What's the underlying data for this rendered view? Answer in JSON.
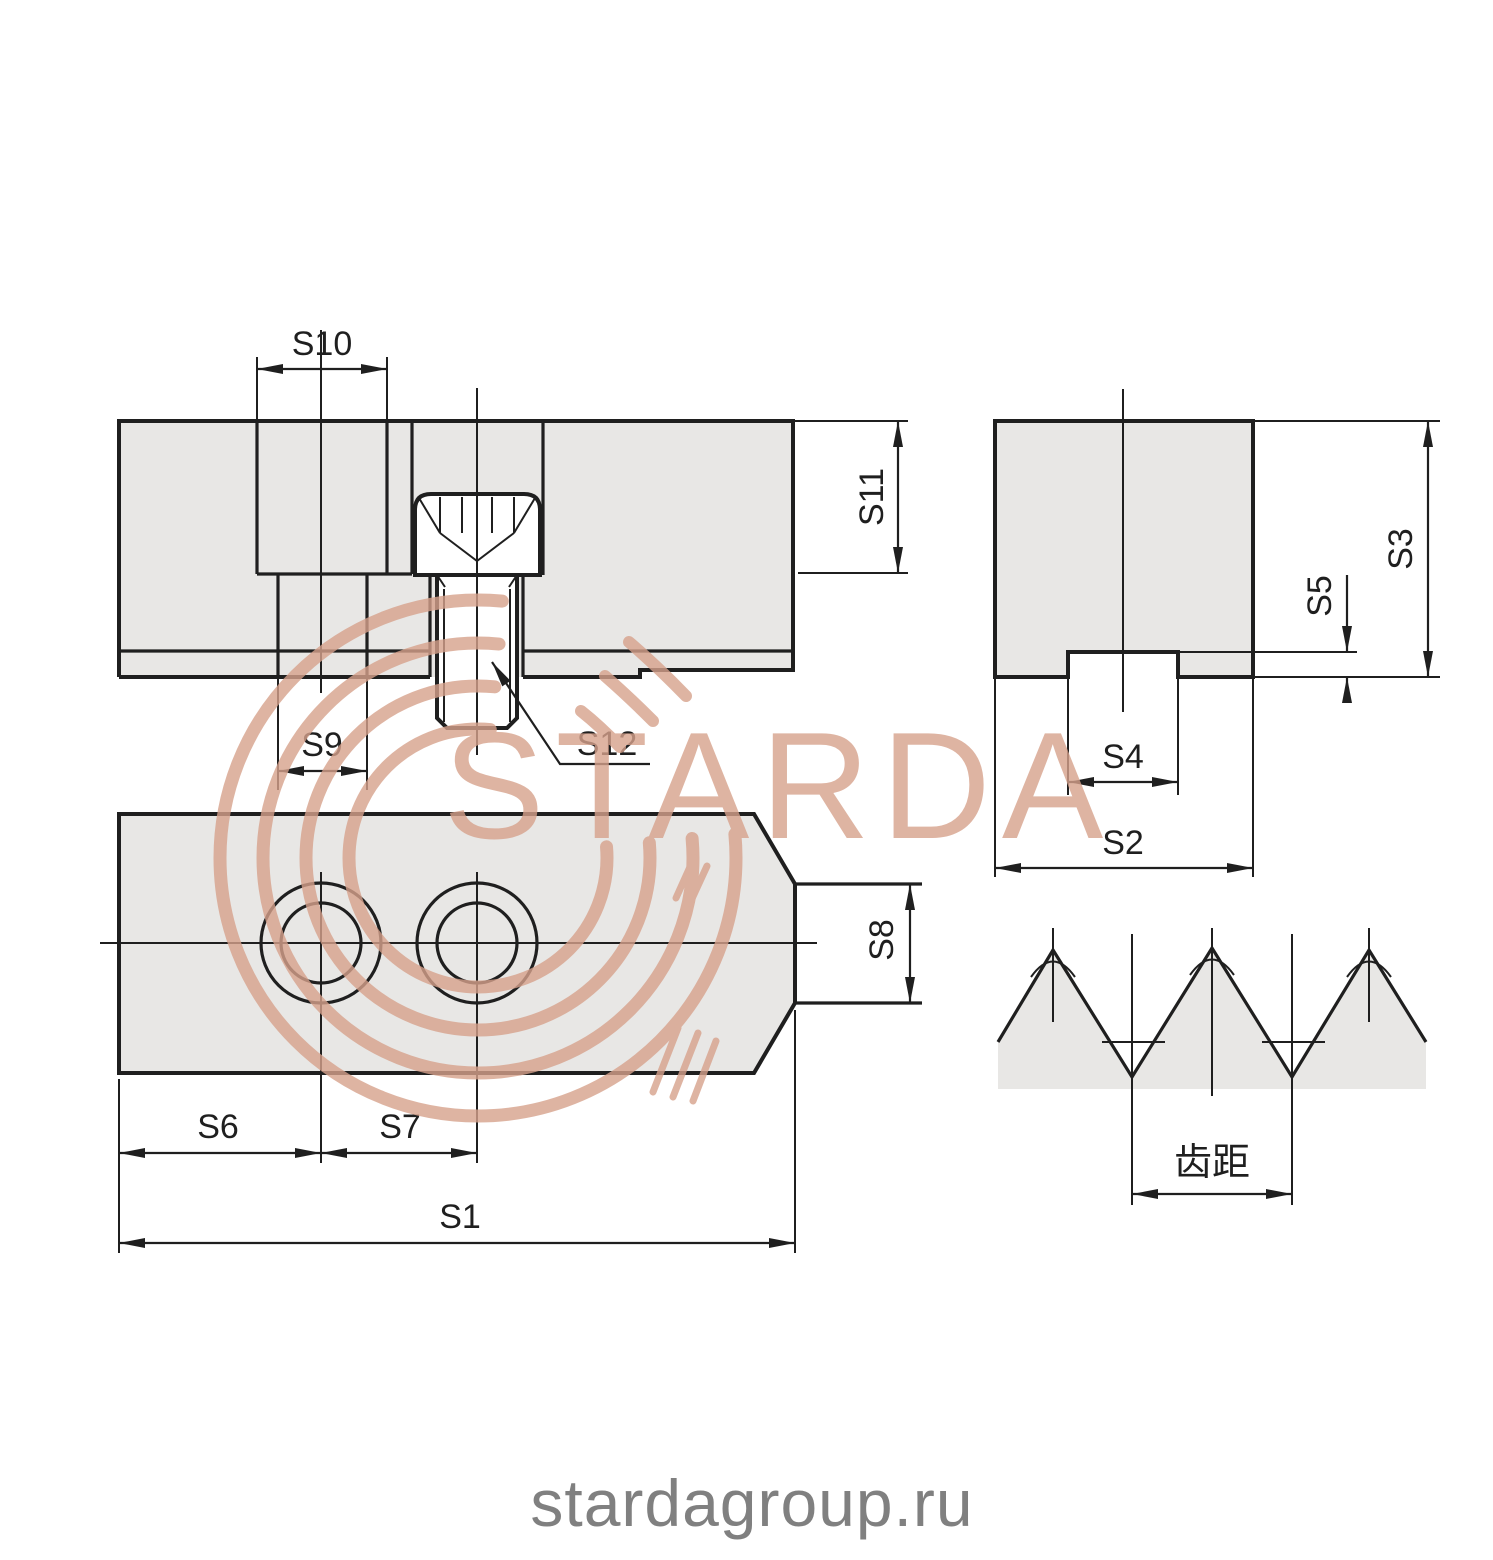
{
  "page": {
    "background": "#ffffff"
  },
  "watermark": {
    "brand": "STARDA",
    "site_url": "stardagroup.ru",
    "accent_color": "#d7a28c",
    "url_text_color": "#808080"
  },
  "drawing": {
    "line_color": "#1f1f1f",
    "fill_color": "#e8e7e5",
    "views": {
      "side_section": {
        "title": "side section view with socket head cap screw",
        "labels": {
          "s9": "S9",
          "s10": "S10",
          "s11": "S11",
          "s12": "S12"
        }
      },
      "end_view": {
        "title": "end view with key slot",
        "labels": {
          "s2": "S2",
          "s3": "S3",
          "s4": "S4",
          "s5": "S5"
        }
      },
      "top_view": {
        "title": "top view with two counterbored holes and tongue",
        "labels": {
          "s1": "S1",
          "s6": "S6",
          "s7": "S7",
          "s8": "S8"
        }
      },
      "serration_detail": {
        "title": "serration tooth profile detail",
        "labels": {
          "pitch": "齿距"
        }
      }
    }
  }
}
